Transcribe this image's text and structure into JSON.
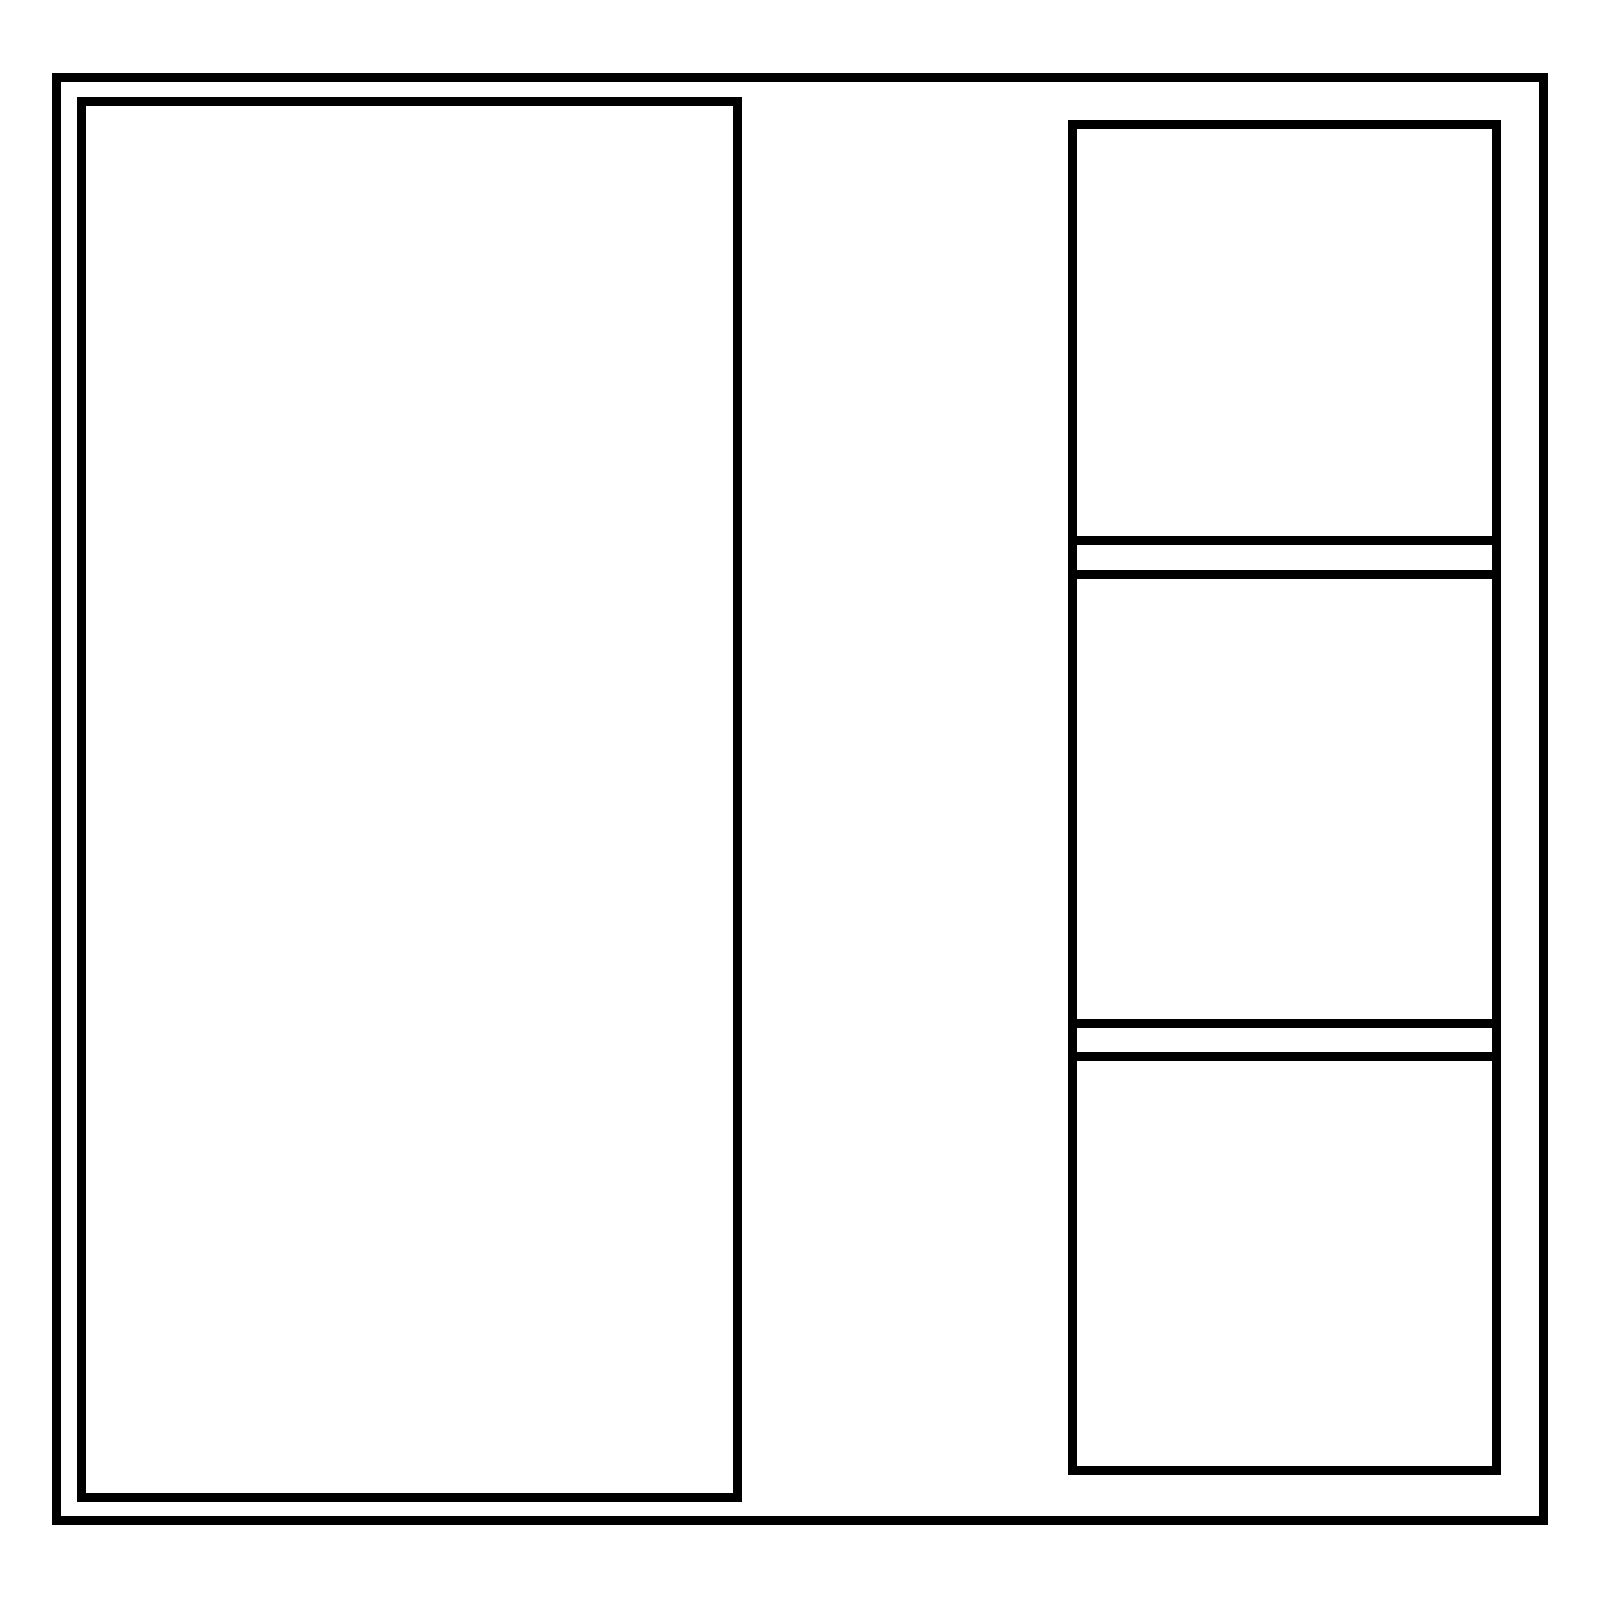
{
  "drawing": {
    "description": "Blank wireframe layout: outer frame, tall left panel, right column of three panels separated by two thin horizontal spacer strips",
    "colors": {
      "background": "#ffffff",
      "stroke": "#000000"
    },
    "stroke_width_px": 9,
    "panels": {
      "outer_frame": "",
      "left_panel": "",
      "right_top_panel": "",
      "right_middle_panel": "",
      "right_bottom_panel": ""
    }
  }
}
